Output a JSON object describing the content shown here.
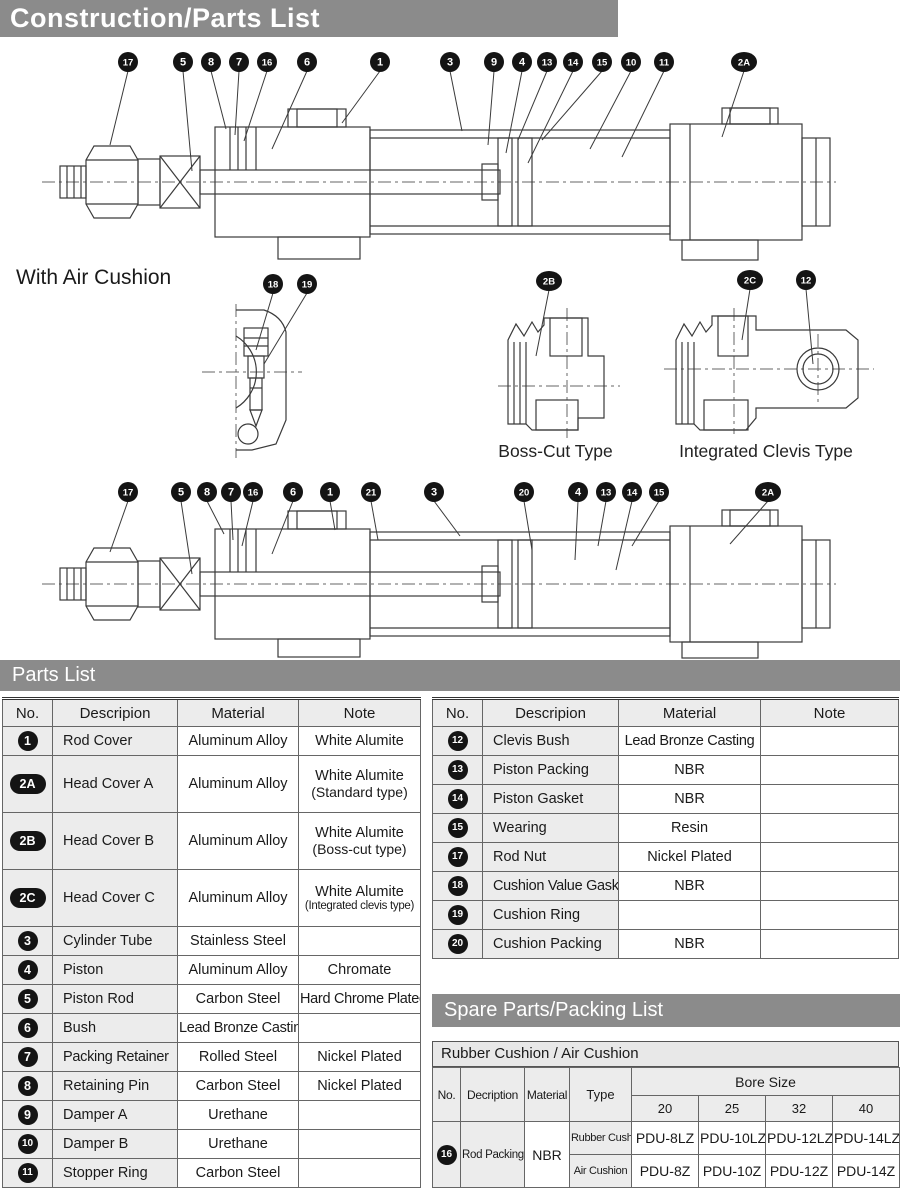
{
  "page": {
    "title": "Construction/Parts List"
  },
  "colors": {
    "banner_gray": "#8b8b8b",
    "header_bg": "#ececec",
    "badge_black": "#141414",
    "line": "#3a3a3a"
  },
  "diagrams": {
    "with_air_cushion_label": "With Air Cushion",
    "boss_cut_label": "Boss-Cut Type",
    "integrated_clevis_label": "Integrated Clevis Type",
    "cylinder1_callouts": [
      {
        "label": "17",
        "x": 98,
        "tx": 80,
        "ty": 100
      },
      {
        "label": "5",
        "x": 153,
        "tx": 162,
        "ty": 126
      },
      {
        "label": "8",
        "x": 181,
        "tx": 196,
        "ty": 84
      },
      {
        "label": "7",
        "x": 209,
        "tx": 205,
        "ty": 90
      },
      {
        "label": "16",
        "x": 237,
        "tx": 214,
        "ty": 96
      },
      {
        "label": "6",
        "x": 277,
        "tx": 242,
        "ty": 104
      },
      {
        "label": "1",
        "x": 350,
        "tx": 312,
        "ty": 78
      },
      {
        "label": "3",
        "x": 420,
        "tx": 432,
        "ty": 86
      },
      {
        "label": "9",
        "x": 464,
        "tx": 458,
        "ty": 100
      },
      {
        "label": "4",
        "x": 492,
        "tx": 476,
        "ty": 108
      },
      {
        "label": "13",
        "x": 517,
        "tx": 488,
        "ty": 95
      },
      {
        "label": "14",
        "x": 543,
        "tx": 498,
        "ty": 118
      },
      {
        "label": "15",
        "x": 572,
        "tx": 512,
        "ty": 95
      },
      {
        "label": "10",
        "x": 601,
        "tx": 560,
        "ty": 104
      },
      {
        "label": "11",
        "x": 634,
        "tx": 592,
        "ty": 112
      },
      {
        "label": "2A",
        "x": 714,
        "tx": 692,
        "ty": 92
      }
    ],
    "cylinder2_callouts": [
      {
        "label": "17",
        "x": 98,
        "tx": 80,
        "ty": 74
      },
      {
        "label": "5",
        "x": 151,
        "tx": 162,
        "ty": 96
      },
      {
        "label": "8",
        "x": 177,
        "tx": 194,
        "ty": 56
      },
      {
        "label": "7",
        "x": 201,
        "tx": 203,
        "ty": 62
      },
      {
        "label": "16",
        "x": 223,
        "tx": 212,
        "ty": 68
      },
      {
        "label": "6",
        "x": 263,
        "tx": 242,
        "ty": 76
      },
      {
        "label": "1",
        "x": 300,
        "tx": 305,
        "ty": 52
      },
      {
        "label": "21",
        "x": 341,
        "tx": 348,
        "ty": 62
      },
      {
        "label": "3",
        "x": 404,
        "tx": 430,
        "ty": 58
      },
      {
        "label": "20",
        "x": 494,
        "tx": 502,
        "ty": 72
      },
      {
        "label": "4",
        "x": 548,
        "tx": 545,
        "ty": 82
      },
      {
        "label": "13",
        "x": 576,
        "tx": 568,
        "ty": 68
      },
      {
        "label": "14",
        "x": 602,
        "tx": 586,
        "ty": 92
      },
      {
        "label": "15",
        "x": 629,
        "tx": 602,
        "ty": 68
      },
      {
        "label": "2A",
        "x": 738,
        "tx": 700,
        "ty": 66
      }
    ],
    "cushion_detail_callouts": [
      {
        "label": "18",
        "x": 83,
        "tx": 66,
        "ty": 78
      },
      {
        "label": "19",
        "x": 117,
        "tx": 74,
        "ty": 92
      }
    ],
    "boss_cut_callouts": [
      {
        "label": "2B",
        "x": 71,
        "tx": 58,
        "ty": 88
      }
    ],
    "integrated_clevis_callouts": [
      {
        "label": "2C",
        "x": 100,
        "tx": 92,
        "ty": 72
      },
      {
        "label": "12",
        "x": 156,
        "tx": 163,
        "ty": 96
      }
    ]
  },
  "parts_list": {
    "title": "Parts List",
    "headers": [
      "No.",
      "Descripion",
      "Material",
      "Note"
    ],
    "left_rows": [
      {
        "no": "1",
        "desc": "Rod Cover",
        "material": "Aluminum Alloy",
        "note": "White Alumite"
      },
      {
        "no": "2A",
        "desc": "Head Cover A",
        "material": "Aluminum Alloy",
        "note": "White Alumite",
        "note2": "(Standard type)"
      },
      {
        "no": "2B",
        "desc": "Head Cover B",
        "material": "Aluminum Alloy",
        "note": "White Alumite",
        "note2": "(Boss-cut type)"
      },
      {
        "no": "2C",
        "desc": "Head Cover C",
        "material": "Aluminum Alloy",
        "note": "White Alumite",
        "note2": "(Integrated clevis type)"
      },
      {
        "no": "3",
        "desc": "Cylinder Tube",
        "material": "Stainless Steel",
        "note": ""
      },
      {
        "no": "4",
        "desc": "Piston",
        "material": "Aluminum Alloy",
        "note": "Chromate"
      },
      {
        "no": "5",
        "desc": "Piston Rod",
        "material": "Carbon Steel",
        "note": "Hard Chrome Plated"
      },
      {
        "no": "6",
        "desc": "Bush",
        "material": "Lead Bronze Casting",
        "note": ""
      },
      {
        "no": "7",
        "desc": "Packing Retainer",
        "material": "Rolled Steel",
        "note": "Nickel Plated"
      },
      {
        "no": "8",
        "desc": "Retaining Pin",
        "material": "Carbon Steel",
        "note": "Nickel Plated"
      },
      {
        "no": "9",
        "desc": "Damper A",
        "material": "Urethane",
        "note": ""
      },
      {
        "no": "10",
        "desc": "Damper B",
        "material": "Urethane",
        "note": ""
      },
      {
        "no": "11",
        "desc": "Stopper Ring",
        "material": "Carbon Steel",
        "note": ""
      }
    ],
    "right_rows": [
      {
        "no": "12",
        "desc": "Clevis Bush",
        "material": "Lead Bronze Casting",
        "note": ""
      },
      {
        "no": "13",
        "desc": "Piston Packing",
        "material": "NBR",
        "note": ""
      },
      {
        "no": "14",
        "desc": "Piston Gasket",
        "material": "NBR",
        "note": ""
      },
      {
        "no": "15",
        "desc": "Wearing",
        "material": "Resin",
        "note": ""
      },
      {
        "no": "17",
        "desc": "Rod Nut",
        "material": "Nickel Plated",
        "note": ""
      },
      {
        "no": "18",
        "desc": "Cushion Value Gasket",
        "material": "NBR",
        "note": ""
      },
      {
        "no": "19",
        "desc": "Cushion Ring",
        "material": "",
        "note": ""
      },
      {
        "no": "20",
        "desc": "Cushion Packing",
        "material": "NBR",
        "note": ""
      }
    ]
  },
  "spare_parts": {
    "title": "Spare Parts/Packing List",
    "subtitle": "Rubber Cushion / Air Cushion",
    "col_headers": [
      "No.",
      "Decription",
      "Material",
      "Type"
    ],
    "bore_header": "Bore Size",
    "bore_sizes": [
      "20",
      "25",
      "32",
      "40"
    ],
    "row": {
      "no": "16",
      "desc": "Rod Packing",
      "material": "NBR",
      "types": [
        {
          "label": "Rubber Cushion",
          "values": [
            "PDU-8LZ",
            "PDU-10LZ",
            "PDU-12LZ",
            "PDU-14LZ"
          ]
        },
        {
          "label": "Air Cushion",
          "values": [
            "PDU-8Z",
            "PDU-10Z",
            "PDU-12Z",
            "PDU-14Z"
          ]
        }
      ]
    }
  }
}
